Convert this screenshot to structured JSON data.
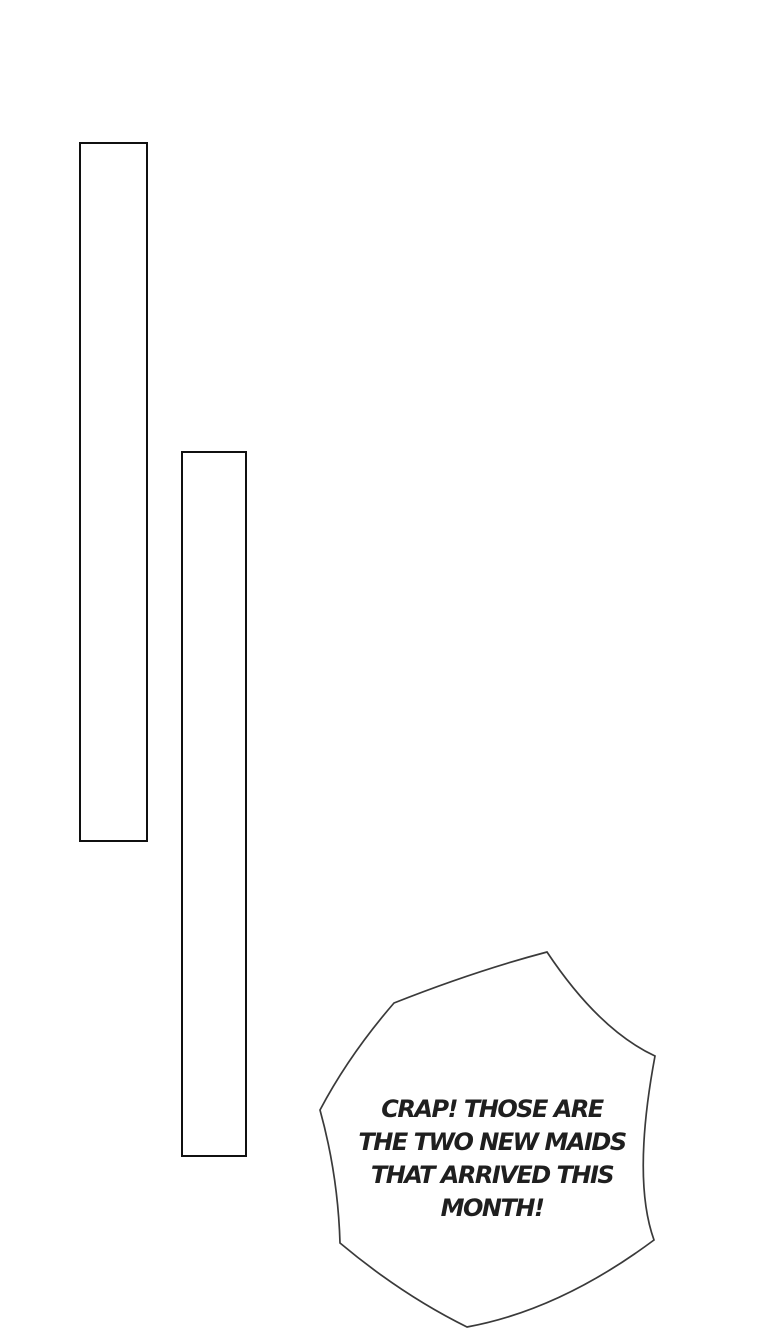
{
  "page": {
    "type": "comic-page",
    "background_color": "#ffffff"
  },
  "panels": [
    {
      "id": "panel-outline-left",
      "border_color": "#101010",
      "fill_color": "#ffffff"
    },
    {
      "id": "panel-outline-right",
      "border_color": "#101010",
      "fill_color": "#ffffff"
    }
  ],
  "speech_bubble": {
    "shape": "spiky-flash-bubble",
    "fill_color": "#ffffff",
    "stroke_color": "#3a3a3a",
    "text_color": "#1f1f1f",
    "text": "CRAP! THOSE ARE THE TWO NEW MAIDS THAT ARRIVED THIS MONTH!",
    "lines": [
      "CRAP! THOSE ARE",
      "THE TWO NEW MAIDS",
      "THAT ARRIVED THIS",
      "MONTH!"
    ]
  }
}
